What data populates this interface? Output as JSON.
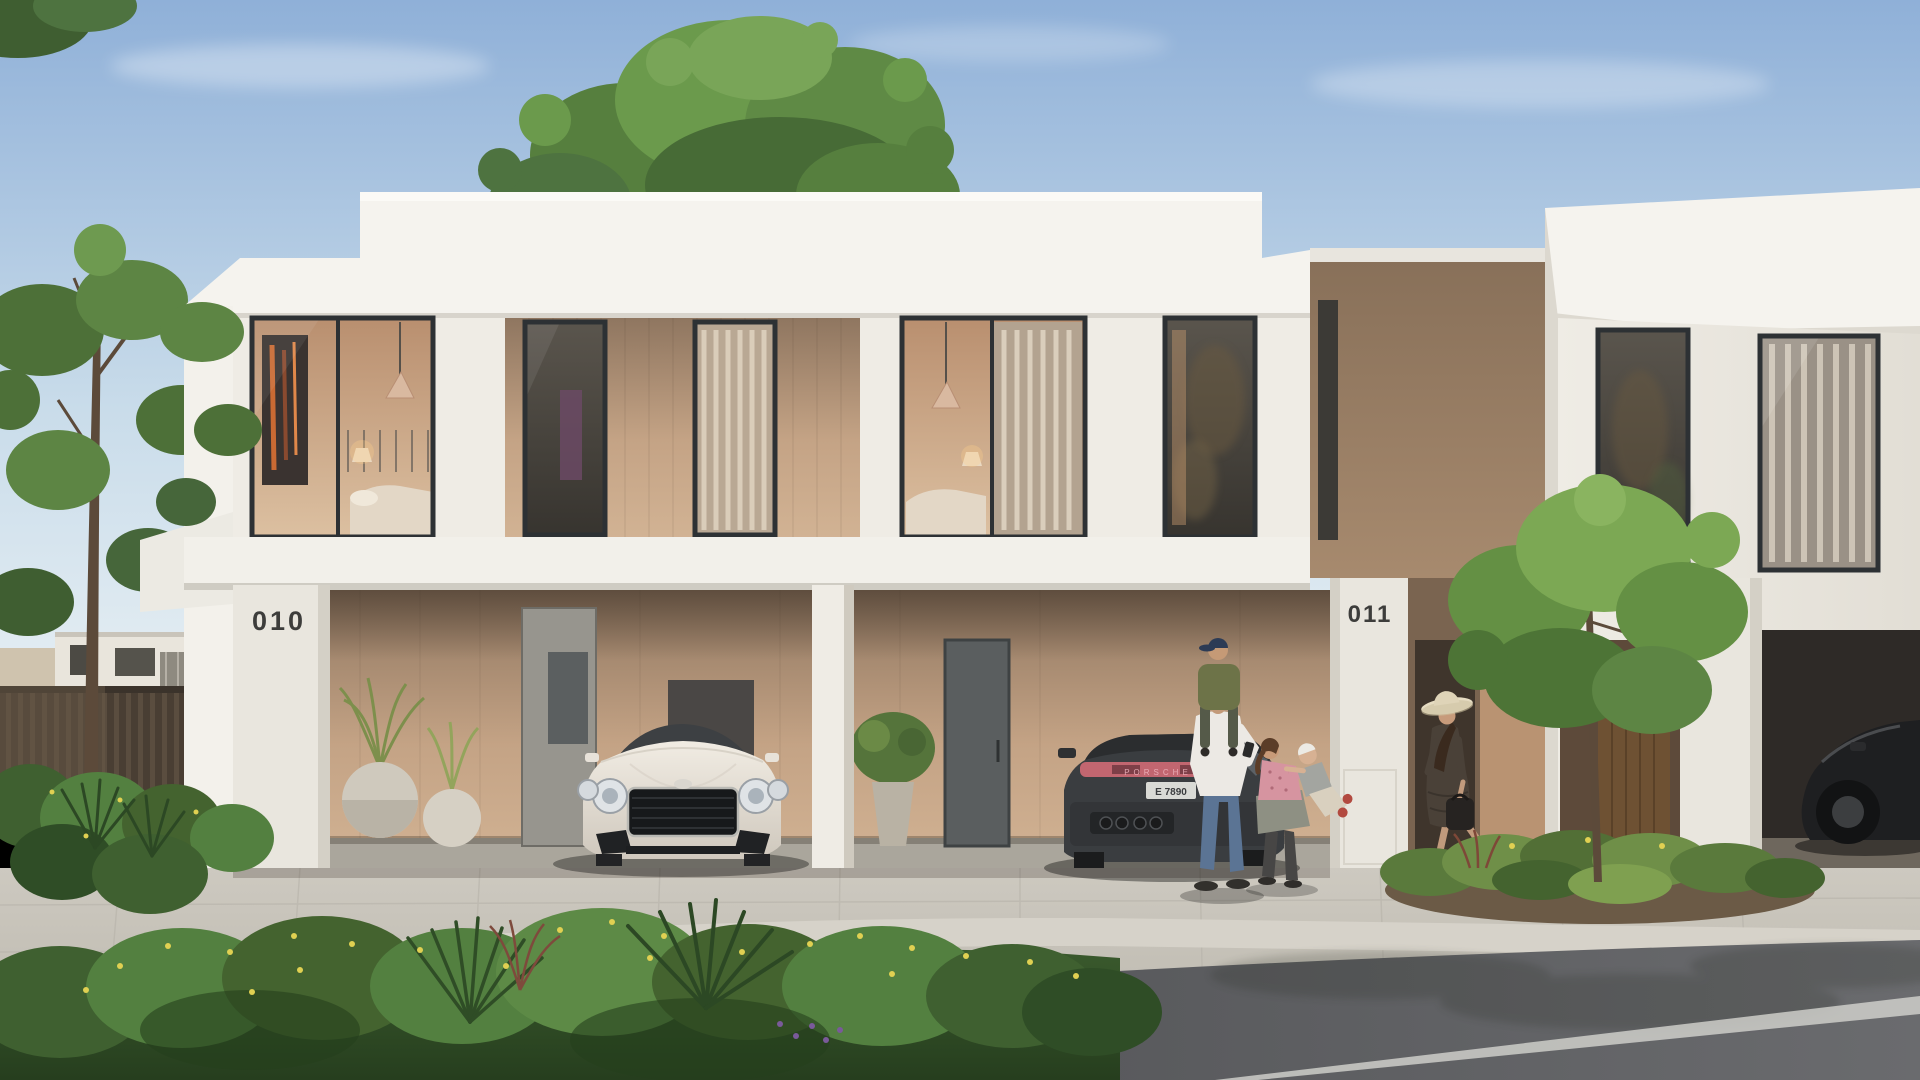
{
  "scene": {
    "type": "architectural-exterior-rendering",
    "description": "Modern white two-storey townhouses with open carports on a sunny day; a white coupe and a dark estate car are parked; a man carries a boy on his shoulders, a girl plays with a toddler, and a woman in a sun hat walks by a young tree.",
    "time_of_day": "day"
  },
  "units": [
    {
      "id": "unit-010",
      "number": "010"
    },
    {
      "id": "unit-011",
      "number": "011"
    }
  ],
  "vehicles": {
    "rear_badge": "PORSCHE",
    "license_plate": "E 7890"
  },
  "colors": {
    "sky-top": "#8fb0d8",
    "sky-mid": "#c9dcea",
    "sky-bottom": "#e2ecf2",
    "fascia": "#f5f3ee",
    "facade": "#efece5",
    "facade-shade": "#ddd9d0",
    "slab": "#f2f0ea",
    "pillar": "#e9e6de",
    "wood-top": "#8f7660",
    "wood": "#c4a385",
    "wood-light": "#d2b394",
    "glass-dark": "#3e3b37",
    "glass-warm": "#c9a98c",
    "frame": "#2d3134",
    "pavement": "#c9c5bc",
    "pavement-dark": "#aaa69c",
    "curb": "#d6d2c9",
    "road-dark": "#424346",
    "road-light": "#6a6b6e",
    "marking": "#d5d5cf",
    "foliage-dark": "#3f6030",
    "foliage": "#5f8a45",
    "foliage-light": "#79a558",
    "flower-yellow": "#e0d052",
    "trunk": "#5c4a3a",
    "fence": "#493e33",
    "car-white": "#e9e4da",
    "car-white-shade": "#cfc8bd",
    "car-dark": "#3a3d40",
    "car-black": "#1e1f21",
    "accent-pink": "#c26670",
    "plate-bg": "#d9dad5",
    "number-text": "#3d3d3b",
    "skin": "#c39a79",
    "tee": "#ece9e4",
    "jeans": "#5b7494",
    "olive": "#6d7348",
    "boy-cap": "#2c3b55",
    "pink-top": "#d694a0",
    "wrap": "#8e9083",
    "leggings": "#474645",
    "toddler-top": "#a3a5a0",
    "toddler-pants": "#d9d0bf",
    "red-shoe": "#b24a40",
    "dress": "#4a4138",
    "hat": "#e6dcc2",
    "bag": "#262321"
  }
}
